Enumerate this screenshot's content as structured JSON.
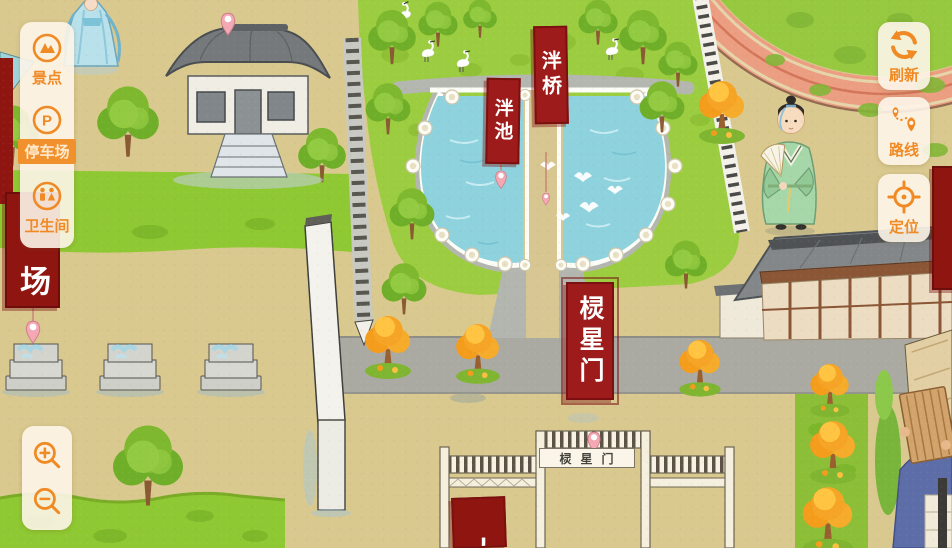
{
  "left_toolbar": {
    "items": [
      {
        "id": "scenic",
        "label": "景点",
        "icon": "scenic-icon"
      },
      {
        "id": "parking",
        "label": "停车场",
        "icon": "parking-icon",
        "active": true
      },
      {
        "id": "restroom",
        "label": "卫生间",
        "icon": "restroom-icon"
      }
    ],
    "parking_glyph": "P"
  },
  "right_toolbar": {
    "items": [
      {
        "id": "refresh",
        "label": "刷新",
        "icon": "refresh-icon"
      },
      {
        "id": "route",
        "label": "路线",
        "icon": "route-icon"
      },
      {
        "id": "locate",
        "label": "定位",
        "icon": "locate-icon"
      }
    ]
  },
  "map": {
    "labels": {
      "pan_bridge": "泮桥",
      "pan_pond": "泮池",
      "lingxing_banner": "棂星门",
      "gate_plaque": "棂星门",
      "parking_partial": "场",
      "bottom_partial": "大"
    }
  },
  "colors": {
    "accent": "#f08a25",
    "active_bg": "#f0912e",
    "banner_red": "#9e1b1b",
    "deep_red": "#8f1511",
    "water": "#8ed2de",
    "lawn": "#9ccd40",
    "ground": "#d9c98f"
  }
}
